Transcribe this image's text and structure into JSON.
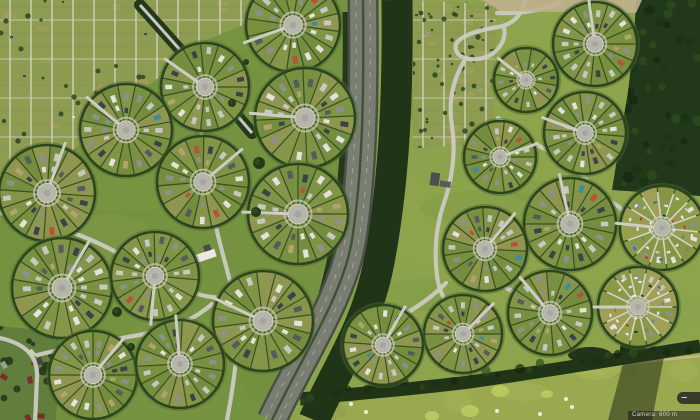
{
  "ui": {
    "zoom_control": {
      "zoom_out_label": "−",
      "zoom_in_label": "+"
    },
    "attribution": {
      "text": "Camera: 600 m"
    }
  },
  "scene": {
    "palette": {
      "grass_west": "#74923f",
      "grass_east": "#8da44c",
      "mottle": [
        "#85a14b",
        "#69883a",
        "#93a956"
      ],
      "road": "#cbcbc2",
      "tree_dark": "#203517",
      "tree_band": "#24391b",
      "hedge": "#2c451e",
      "asphalt": "#7a7e72",
      "asphalt_edge": "#4a4f45",
      "median": "#3f5132",
      "lane": "#b9bdb2",
      "plaza": "#b6b6ac",
      "plaza_edge": "#d8d8cf",
      "drive": "#cdcdc4",
      "forest": "#22381a",
      "forest_mottle": [
        "#16280f",
        "#2f4d1e",
        "#1b3113"
      ],
      "allot_base": "#8e9c52",
      "allot_path": "#d8d8cc",
      "allot_row": "#7e8f48",
      "allot_tan": "#a89e60",
      "allot_dot": "#2d4520",
      "golf": "#9aa850",
      "golf_green": "#b7c95f",
      "bunker": "#f0ead8",
      "sand_path": "#c9bd92",
      "suburb_base": "#627e3d",
      "shadow": "rgba(25,35,15,0.5)",
      "dirt": "#c0b08e",
      "wedge": [
        "#86984a",
        "#a29b5b",
        "#75903e",
        "#8f9952",
        "#6f8a3a"
      ],
      "house_lush": [
        "#3c4247",
        "#3c4247",
        "#565b5e",
        "#8d918c",
        "#8d918c",
        "#c6c8c2",
        "#c6c8c2",
        "#c6c8c2",
        "#e3e3de",
        "#e3e3de",
        "#b3a469"
      ],
      "house_rare": [
        "#b85138",
        "#3d8ba3"
      ],
      "car": [
        "#e8e8e4",
        "#e8e8e4",
        "#e8e8e4",
        "#2e3337",
        "#c23b2e",
        "#2f6fae",
        "#c9cdd1",
        "#777d82"
      ],
      "spoke_new": "#dcdcd2",
      "circle_base_lush": "#7b9042",
      "circle_base_new": "#9da24f",
      "ring_grass": "#4e6a2e",
      "plaza_ring": "#c8c8be"
    },
    "east_tint_poly": "363,0 700,0 700,420 272,420 352,240",
    "mottle_seed": 99,
    "mottle_count": 26,
    "highway": {
      "center": "M363,0 C364,90 363,170 352,240 C343,296 300,360 272,420",
      "lane_left": "M356,0 C357,90 356,170 345,240 C336,296 293,360 265,420",
      "lane_right": "M370,0 C371,90 370,170 359,240 C350,296 307,360 279,420",
      "tree_west": "M347,12 C348,90 346,175 333,252 C322,310 300,362 284,420",
      "tree_east": "M397,0 C398,88 395,178 379,262 C366,330 336,368 314,420"
    },
    "diag_road": "M140,5 C176,45 214,88 252,133",
    "roads": [
      "M200,78 C196,120 206,158 211,198 C215,232 227,266 234,298 C240,324 238,362 227,420",
      "M0,213 C48,222 94,238 124,257 C151,274 176,289 205,296 C226,300 243,297 254,289",
      "M0,338 C26,344 38,356 37,378 C36,394 36,408 35,420",
      "M37,355 C78,345 118,339 150,333 C176,328 196,318 212,304",
      "M527,-4 C523,12 516,24 498,27 C474,31 452,38 456,50 C459,61 480,62 492,54 C502,47 506,37 504,27",
      "M497,13 C520,14 542,10 560,3",
      "M466,58 C452,80 448,102 452,126 C456,152 452,180 443,206 C436,228 434,252 437,276 C440,299 452,312 468,323",
      "M498,118 C512,130 527,141 545,149 C563,157 577,168 586,179 C594,189 602,197 613,203 C624,209 631,219 635,231",
      "M505,287 C518,295 531,301 545,308",
      "M635,231 C641,251 641,269 637,287",
      "M405,314 C424,303 436,293 446,283"
    ],
    "bottom_band": "M300,399 C356,394 420,388 470,382 C540,372 600,362 700,346",
    "band_blob": [
      590,
      355,
      22,
      8
    ],
    "forest": {
      "poly": "636,0 700,0 700,196 612,190 620,140 628,92 634,40",
      "bbox": [
        608,
        0,
        92,
        196
      ],
      "dots": 48,
      "seed": 21
    },
    "dirt_poly": "482,0 642,0 636,13 500,11",
    "allotments": [
      {
        "poly": "0,0 265,0 265,16 206,40 148,86 94,134 36,178 0,196",
        "bbox": [
          0,
          0,
          265,
          196
        ],
        "seed": 7
      },
      {
        "poly": "413,0 497,4 492,144 413,148",
        "bbox": [
          413,
          0,
          84,
          148
        ],
        "seed": 11
      }
    ],
    "suburb": {
      "poly": "0,326 60,332 56,420 0,420",
      "bbox": [
        0,
        326,
        60,
        94
      ],
      "seed": 3
    },
    "golf": {
      "poly": "302,405 470,387 580,364 700,348 700,420 302,420",
      "bbox": [
        302,
        348,
        398,
        72
      ],
      "seed": 17,
      "greens": [
        [
          500,
          391,
          9,
          6
        ],
        [
          547,
          394,
          6,
          4
        ],
        [
          470,
          411,
          9,
          6
        ],
        [
          432,
          416,
          7,
          5
        ]
      ],
      "bunkers": [
        [
          566,
          399
        ],
        [
          572,
          407
        ],
        [
          540,
          414
        ],
        [
          497,
          411
        ],
        [
          366,
          412
        ],
        [
          351,
          404
        ]
      ],
      "sand_path": "M466,387 C530,376 600,366 700,356",
      "shadow_poly": "627,349 664,357 652,420 608,420",
      "shadow_tree": [
        633,
        349,
        13
      ]
    },
    "buildings": [
      {
        "x": 205,
        "y": 256,
        "rot": -18,
        "parts": [
          [
            -11,
            -4,
            22,
            8,
            "#e9e9e3"
          ],
          [
            1,
            -10,
            7,
            6,
            "#474b4e"
          ]
        ]
      },
      {
        "x": 437,
        "y": 182,
        "rot": 8,
        "parts": [
          [
            -7,
            -9,
            9,
            13,
            "#4c5052"
          ],
          [
            3,
            -2,
            11,
            6,
            "#585c5e"
          ]
        ]
      },
      {
        "x": 455,
        "y": 267,
        "rot": 40,
        "parts": [
          [
            -2,
            -1,
            4,
            2,
            "#eeeeea"
          ]
        ]
      }
    ],
    "lone_trees": [
      [
        232,
        103,
        4
      ],
      [
        259,
        163,
        6
      ],
      [
        256,
        212,
        5
      ],
      [
        117,
        312,
        5
      ],
      [
        131,
        347,
        4
      ],
      [
        246,
        62,
        3
      ]
    ],
    "circles": [
      {
        "id": "W1",
        "x": 293,
        "y": 25,
        "r": 47,
        "t": "lush",
        "n": 16,
        "rot": 8,
        "drive": 160
      },
      {
        "id": "W2",
        "x": 205,
        "y": 87,
        "r": 44,
        "t": "lush",
        "n": 15,
        "rot": 0,
        "drive": 215
      },
      {
        "id": "W3",
        "x": 126,
        "y": 130,
        "r": 46,
        "t": "lush",
        "n": 16,
        "rot": 12,
        "drive": 220
      },
      {
        "id": "W4",
        "x": 47,
        "y": 193,
        "r": 48,
        "t": "lush",
        "n": 16,
        "rot": 4,
        "drive": 290
      },
      {
        "id": "W5",
        "x": 305,
        "y": 118,
        "r": 50,
        "t": "lush",
        "n": 16,
        "rot": 20,
        "drive": 185
      },
      {
        "id": "W6",
        "x": 203,
        "y": 182,
        "r": 46,
        "t": "lush",
        "n": 15,
        "rot": 7,
        "drive": 320
      },
      {
        "id": "W7",
        "x": 298,
        "y": 214,
        "r": 50,
        "t": "lush",
        "n": 16,
        "rot": 0,
        "drive": 182
      },
      {
        "id": "W8",
        "x": 62,
        "y": 288,
        "r": 50,
        "t": "lush",
        "n": 16,
        "rot": 10,
        "drive": 300
      },
      {
        "id": "W9",
        "x": 155,
        "y": 276,
        "r": 44,
        "t": "lush",
        "n": 15,
        "rot": 5,
        "drive": 95
      },
      {
        "id": "W10",
        "x": 263,
        "y": 321,
        "r": 50,
        "t": "lush",
        "n": 16,
        "rot": 15,
        "drive": 205
      },
      {
        "id": "W11",
        "x": 93,
        "y": 375,
        "r": 44,
        "t": "lush",
        "n": 16,
        "rot": 0,
        "drive": 310
      },
      {
        "id": "W12",
        "x": 180,
        "y": 364,
        "r": 44,
        "t": "lush",
        "n": 15,
        "rot": 9,
        "drive": 265
      },
      {
        "id": "E1",
        "x": 595,
        "y": 44,
        "r": 42,
        "t": "lush",
        "n": 15,
        "rot": 0,
        "drive": 262
      },
      {
        "id": "E2",
        "x": 526,
        "y": 80,
        "r": 32,
        "t": "lush",
        "n": 12,
        "rot": 10,
        "drive": 218
      },
      {
        "id": "E3",
        "x": 585,
        "y": 133,
        "r": 41,
        "t": "lush",
        "n": 14,
        "rot": 5,
        "drive": 200
      },
      {
        "id": "E4",
        "x": 500,
        "y": 157,
        "r": 36,
        "t": "lush",
        "n": 13,
        "rot": 0,
        "drive": 340
      },
      {
        "id": "E5",
        "x": 570,
        "y": 224,
        "r": 46,
        "t": "lush",
        "n": 15,
        "rot": 12,
        "drive": 258
      },
      {
        "id": "E6",
        "x": 662,
        "y": 228,
        "r": 42,
        "t": "new",
        "n": 14,
        "rot": 6,
        "drive": 186
      },
      {
        "id": "E7",
        "x": 485,
        "y": 249,
        "r": 42,
        "t": "lush",
        "n": 15,
        "rot": 3,
        "drive": 310
      },
      {
        "id": "E8",
        "x": 463,
        "y": 334,
        "r": 39,
        "t": "lush",
        "n": 14,
        "rot": 0,
        "drive": 315
      },
      {
        "id": "E9",
        "x": 550,
        "y": 313,
        "r": 42,
        "t": "lush",
        "n": 14,
        "rot": 8,
        "drive": 230
      },
      {
        "id": "E10",
        "x": 638,
        "y": 307,
        "r": 40,
        "t": "new",
        "n": 14,
        "rot": 0,
        "drive": 180
      },
      {
        "id": "E11",
        "x": 383,
        "y": 345,
        "r": 40,
        "t": "lush",
        "n": 14,
        "rot": 4,
        "drive": 300
      }
    ]
  }
}
